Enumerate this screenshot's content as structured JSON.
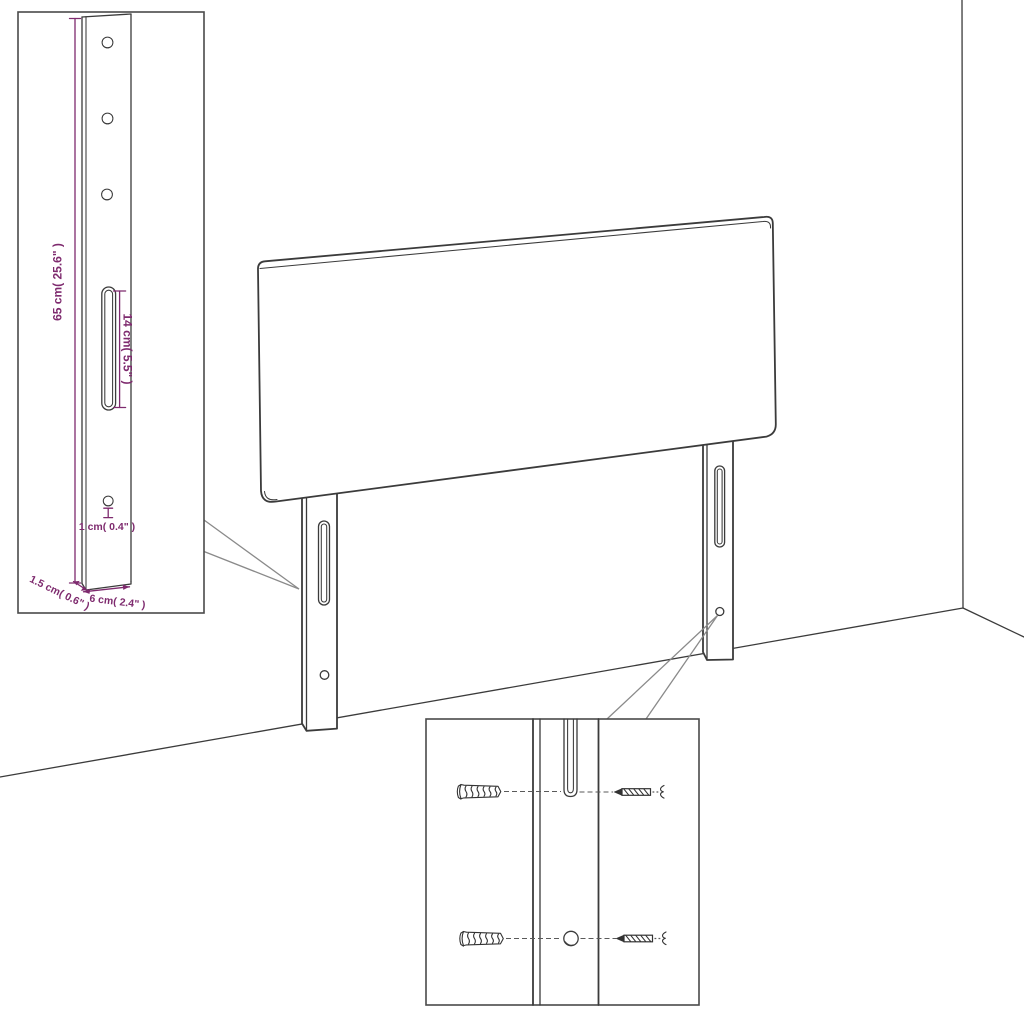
{
  "diagram_title": "headboard-assembly-measurement-diagram",
  "colors": {
    "background": "#ffffff",
    "line": "#3b3b3b",
    "box_border": "#4a4a4a",
    "callout": "#8a8a8a",
    "dimension": "#7e2a6e"
  },
  "leg_detail_inset": {
    "height_label": "65 cm( 25.6\" )",
    "slot_label": "14 cm( 5.5\" )",
    "hole_label": "1 cm( 0.4\" )",
    "depth_label": "1.5 cm( 0.6\" )",
    "width_label": "6 cm( 2.4\" )"
  },
  "components": {
    "main": [
      "headboard-panel",
      "left-mounting-leg",
      "right-mounting-leg",
      "room-corner"
    ],
    "mounting_detail_inset": [
      "wall-plug",
      "screw",
      "mounting-slot",
      "pilot-hole"
    ]
  }
}
